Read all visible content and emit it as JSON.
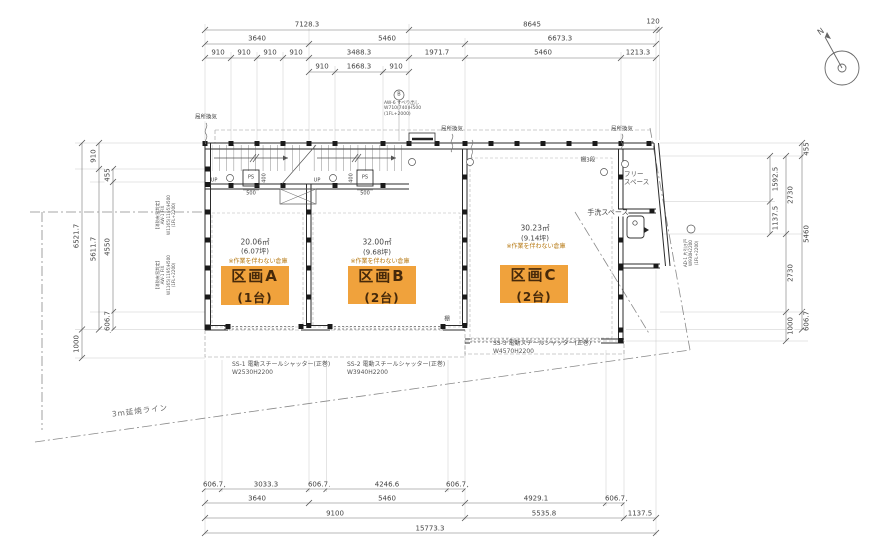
{
  "colors": {
    "accent": "#F0A23C",
    "note": "#B5770F",
    "wall": "#333333",
    "dim": "#555555"
  },
  "dims": {
    "top1": [
      "7128.3",
      "8645",
      "120"
    ],
    "top2": [
      "3640",
      "5460",
      "6673.3"
    ],
    "top3": [
      "910",
      "910",
      "910",
      "910",
      "3488.3",
      "1971.7",
      "5460",
      "1213.3"
    ],
    "top4": [
      "910",
      "1668.3",
      "910"
    ],
    "left": [
      "910",
      "455",
      "4550",
      "606.7",
      "5611.7",
      "6521.7",
      "1000"
    ],
    "right": [
      "455",
      "1592.5",
      "1137.5",
      "2730",
      "2730",
      "5460",
      "1000",
      "606.7"
    ],
    "bot1": [
      "606.7",
      "3033.3",
      "606.7",
      "4246.6",
      "606.7"
    ],
    "bot2": [
      "3640",
      "5460",
      "4929.1",
      "606.7"
    ],
    "bot3": [
      "9100",
      "5535.8",
      "1137.5"
    ],
    "bot4": [
      "15773.3"
    ],
    "stair_width": "500",
    "ps_depth": "400"
  },
  "sections": [
    {
      "name": "区画A",
      "capacity": "(1台)",
      "area": "20.06㎡",
      "tsubo": "(6.07坪)",
      "note": "※作業を伴わない倉庫"
    },
    {
      "name": "区画B",
      "capacity": "(2台)",
      "area": "32.00㎡",
      "tsubo": "(9.68坪)",
      "note": "※作業を伴わない倉庫"
    },
    {
      "name": "区画C",
      "capacity": "(2台)",
      "area": "30.23㎡",
      "tsubo": "(9.14坪)",
      "note": "※作業を伴わない倉庫"
    }
  ],
  "shutters": [
    {
      "name": "SS-1 電動スチールシャッター(正巻)",
      "size": "W2530H2200"
    },
    {
      "name": "SS-2 電動スチールシャッター(正巻)",
      "size": "W3940H2200"
    },
    {
      "name": "SS-3 電動スチールシャッター(正巻)",
      "size": "W4570H2200"
    }
  ],
  "labels": {
    "vent": "局所換気",
    "hand_wash": "手洗スペース",
    "free1": "フリー",
    "free2": "スペース",
    "shelf3": "棚3段",
    "shelf": "棚",
    "up": "UP",
    "ps": "PS",
    "fire_line": "3m延焼ライン",
    "north": "N",
    "win_mark": "B",
    "win1": "AW-6 すべり出し",
    "win2": "W710(740)H500",
    "win3": "(1FL+2000)",
    "fire_win1": "【消防有窓判定】",
    "fire_win2": "AW-1 FIX",
    "fire_win3": "W1165(1195)H500",
    "fire_win4": "(1FL+2200)",
    "door1": "AD-1 片引き戸",
    "door2": "W930H2200",
    "door3": "(1FL+2200)"
  }
}
